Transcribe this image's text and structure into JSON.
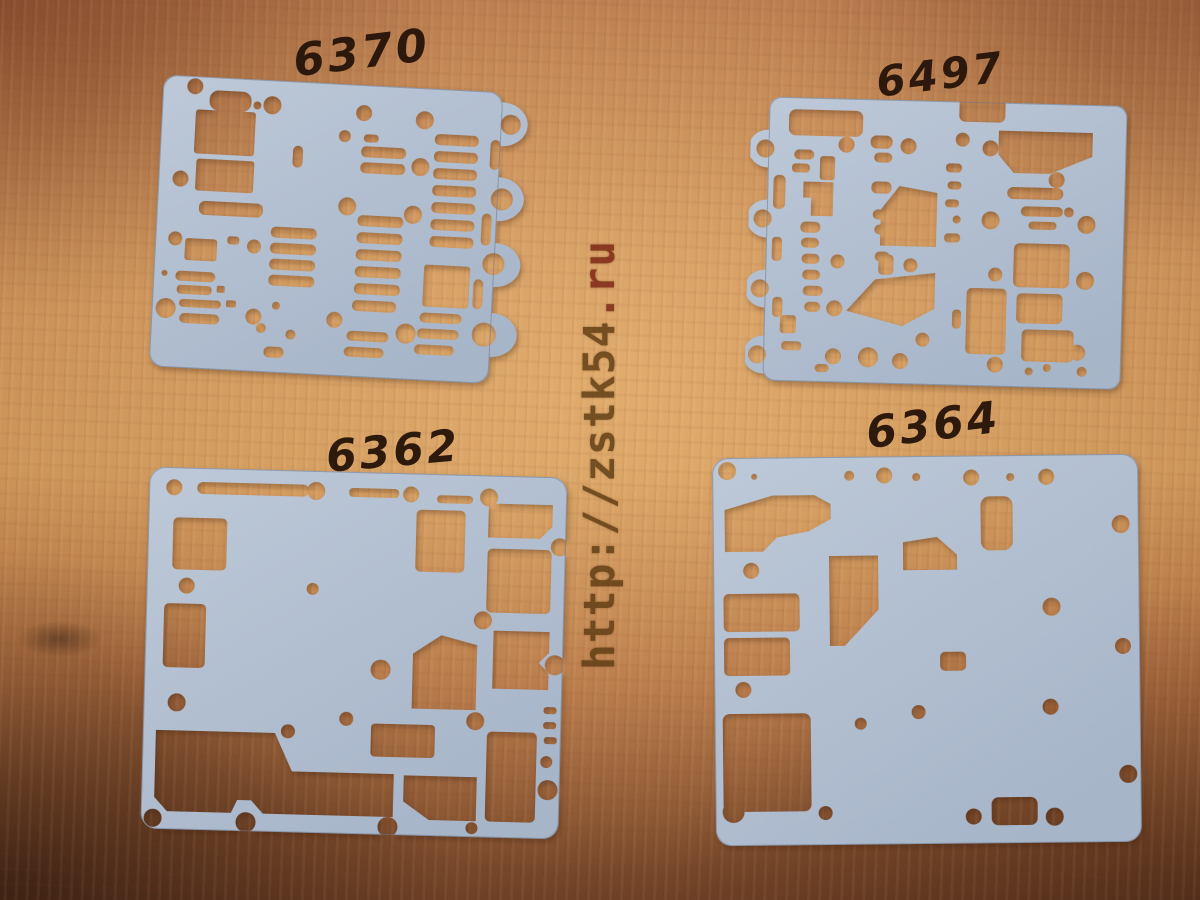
{
  "scene": {
    "type": "photograph",
    "description": "Four light blue-grey automatic transmission valve body separator gaskets laid flat on an orange-brown plywood table, each with a handwritten part number on the wood above it, and a vertical website watermark burned across the middle",
    "surface": "wood table"
  },
  "watermark": {
    "text": "http://zstk54.ru",
    "main": "http://zstk54",
    "tld": ".ru",
    "orientation": "vertical, reads bottom to top"
  },
  "gaskets": [
    {
      "part_number": "6370",
      "position": "top-left"
    },
    {
      "part_number": "6497",
      "position": "top-right"
    },
    {
      "part_number": "6362",
      "position": "bottom-left"
    },
    {
      "part_number": "6364",
      "position": "bottom-right"
    }
  ],
  "colors": {
    "wood_light": "#d2a064",
    "wood_mid": "#b97c48",
    "wood_dark": "#6e4026",
    "gasket": "#b6c2d3",
    "gasket_shade": "#a9b7cb",
    "handwriting_ink": "#241208",
    "watermark_main": "#5c3a10",
    "watermark_tld": "#7a2012"
  }
}
